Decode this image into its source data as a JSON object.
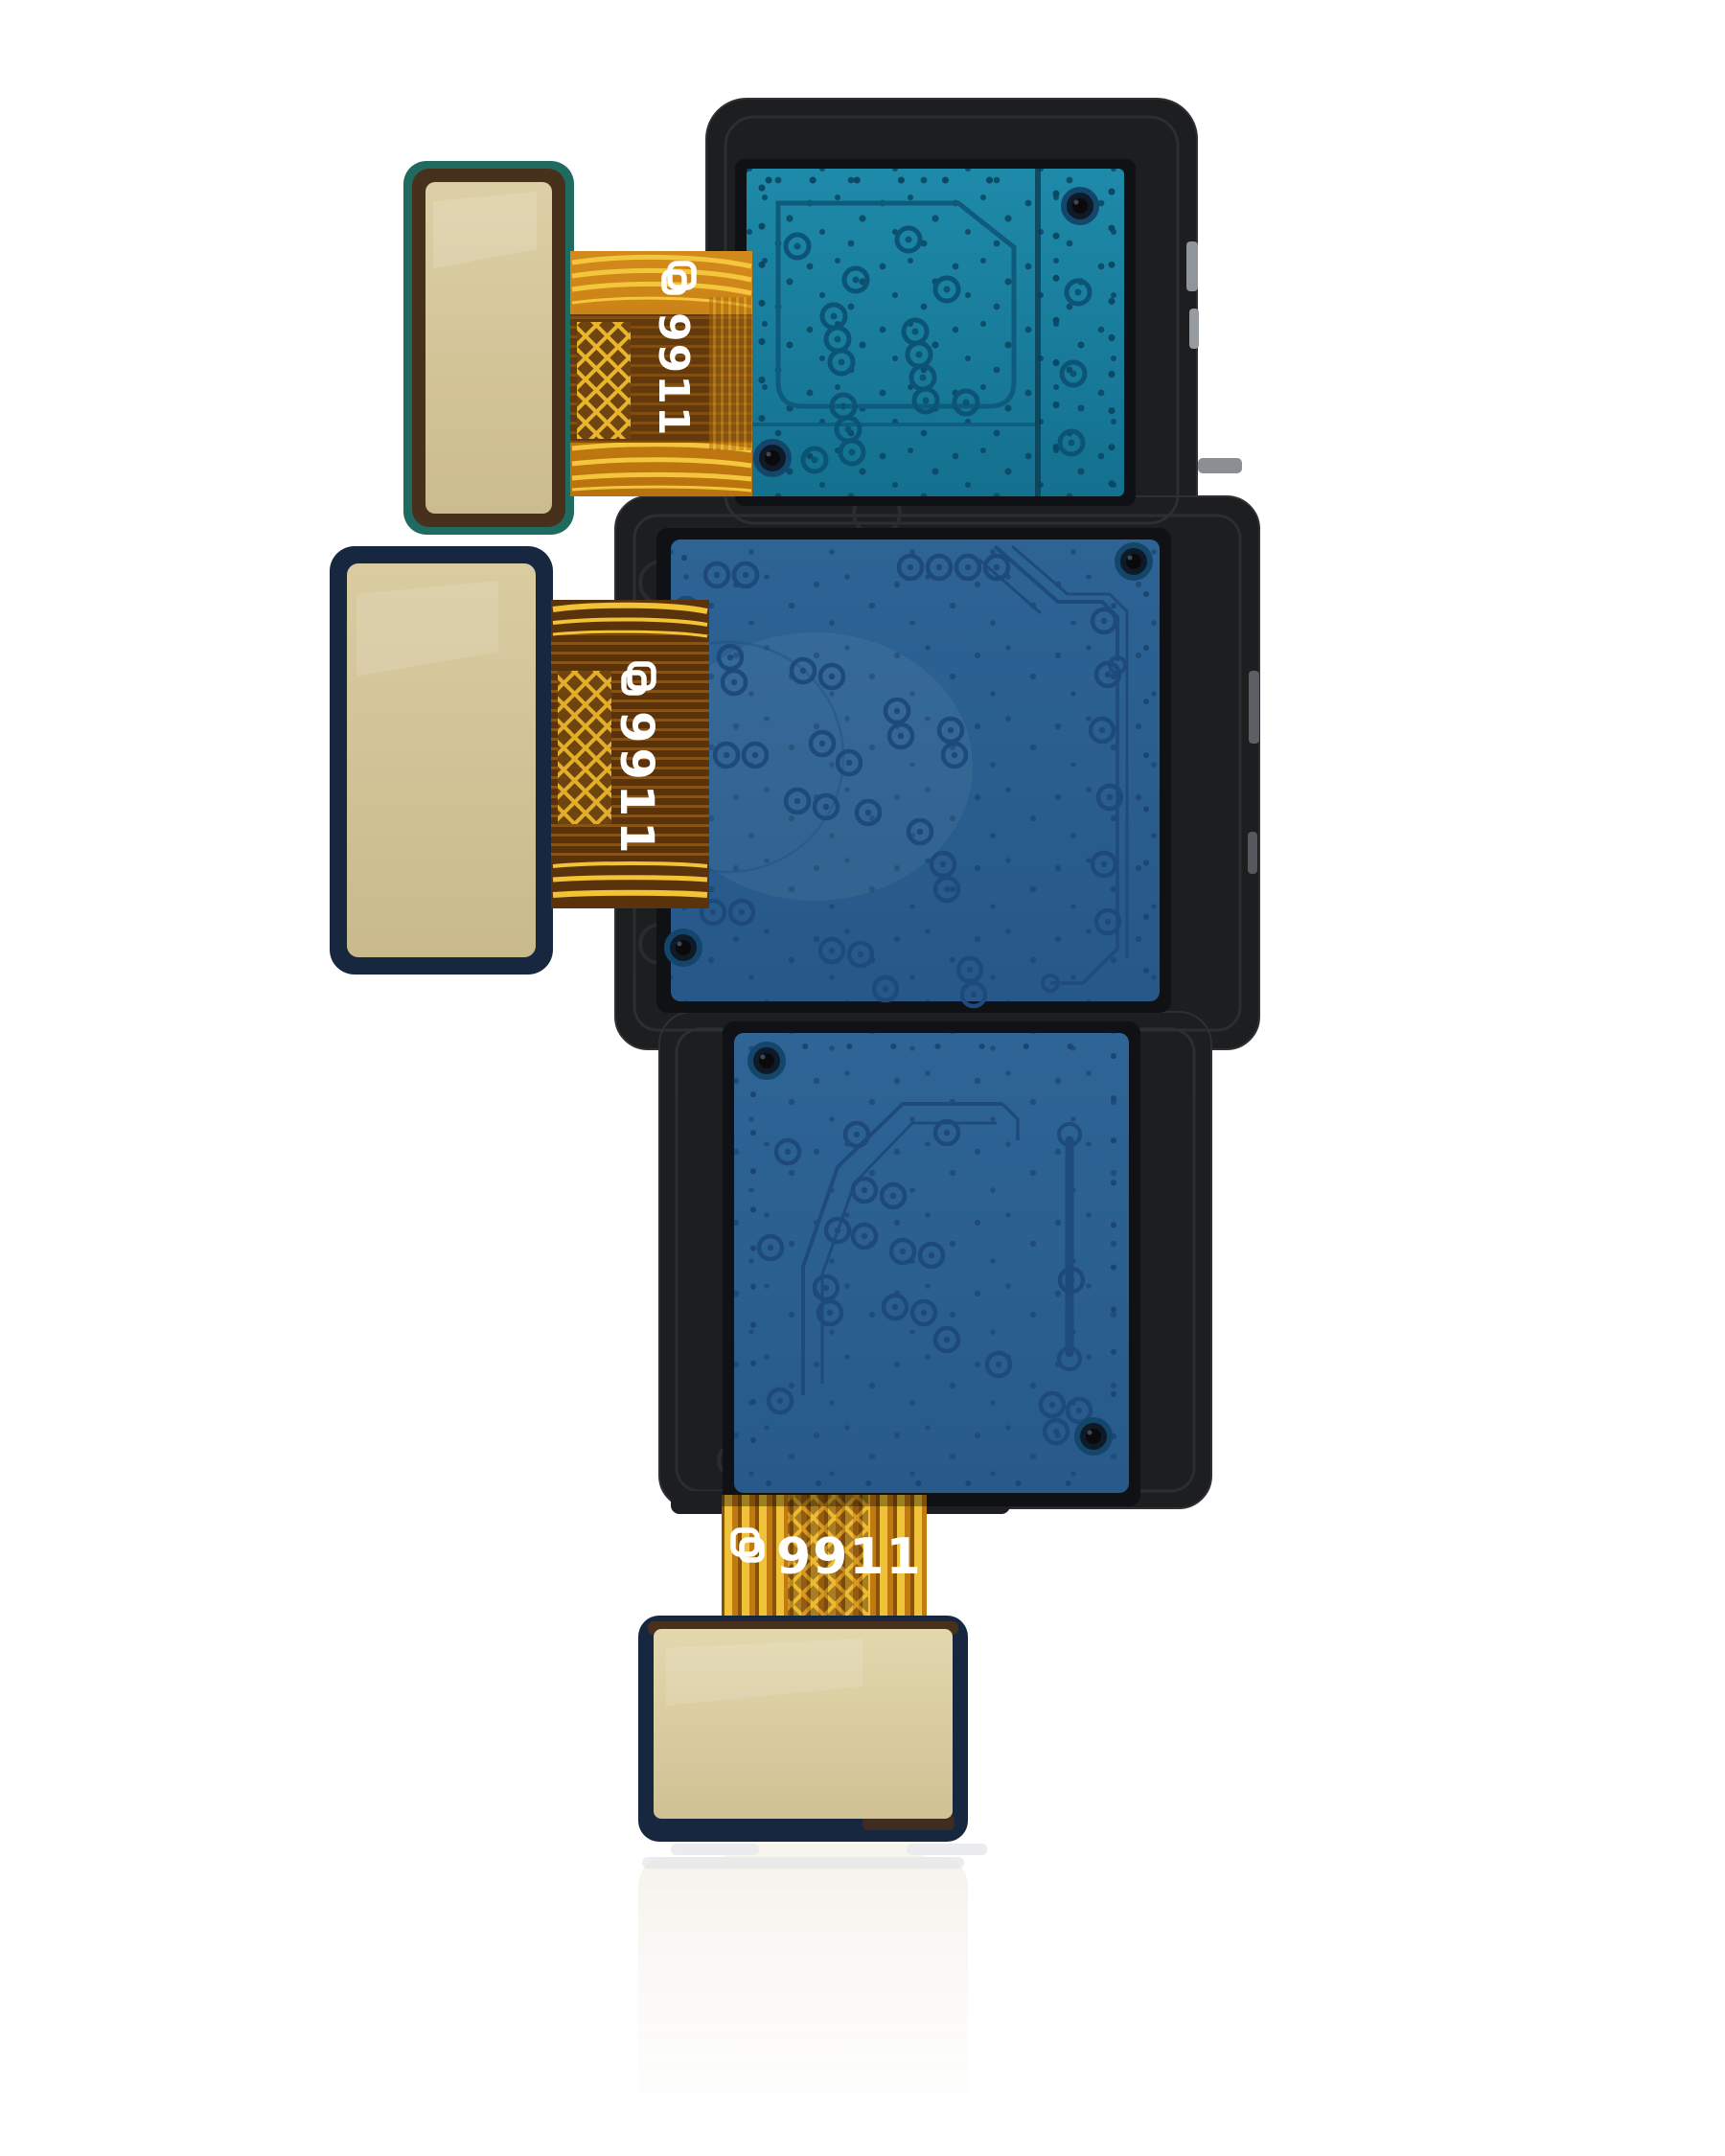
{
  "product": {
    "name": "triple-rear-camera-flex-module",
    "labels": {
      "top_flex": "9911",
      "middle_flex": "9911",
      "bottom_flex": "9911"
    },
    "logo_mark": "manufacturer-logo"
  },
  "colors": {
    "background": "#ffffff",
    "housing": "#1d1e20",
    "housing_seam": "#303236",
    "recess": "#101114",
    "pcb_teal": "#18809f",
    "pcb_teal_trace": "#0e5b7e",
    "pcb_blue": "#2a5e8e",
    "pcb_blue_trace": "#1e4b7b",
    "flex_orange": "#c97f16",
    "flex_gold": "#f0c23a",
    "flex_shadow": "#5a330d",
    "pad_gold": "#d7c89c",
    "pad_border_navy": "#17273f",
    "pad_border_brown": "#47311d",
    "pad_edge_green": "#1f6b5f",
    "label_text": "#ffffff",
    "reflection": "#f3efe7"
  }
}
